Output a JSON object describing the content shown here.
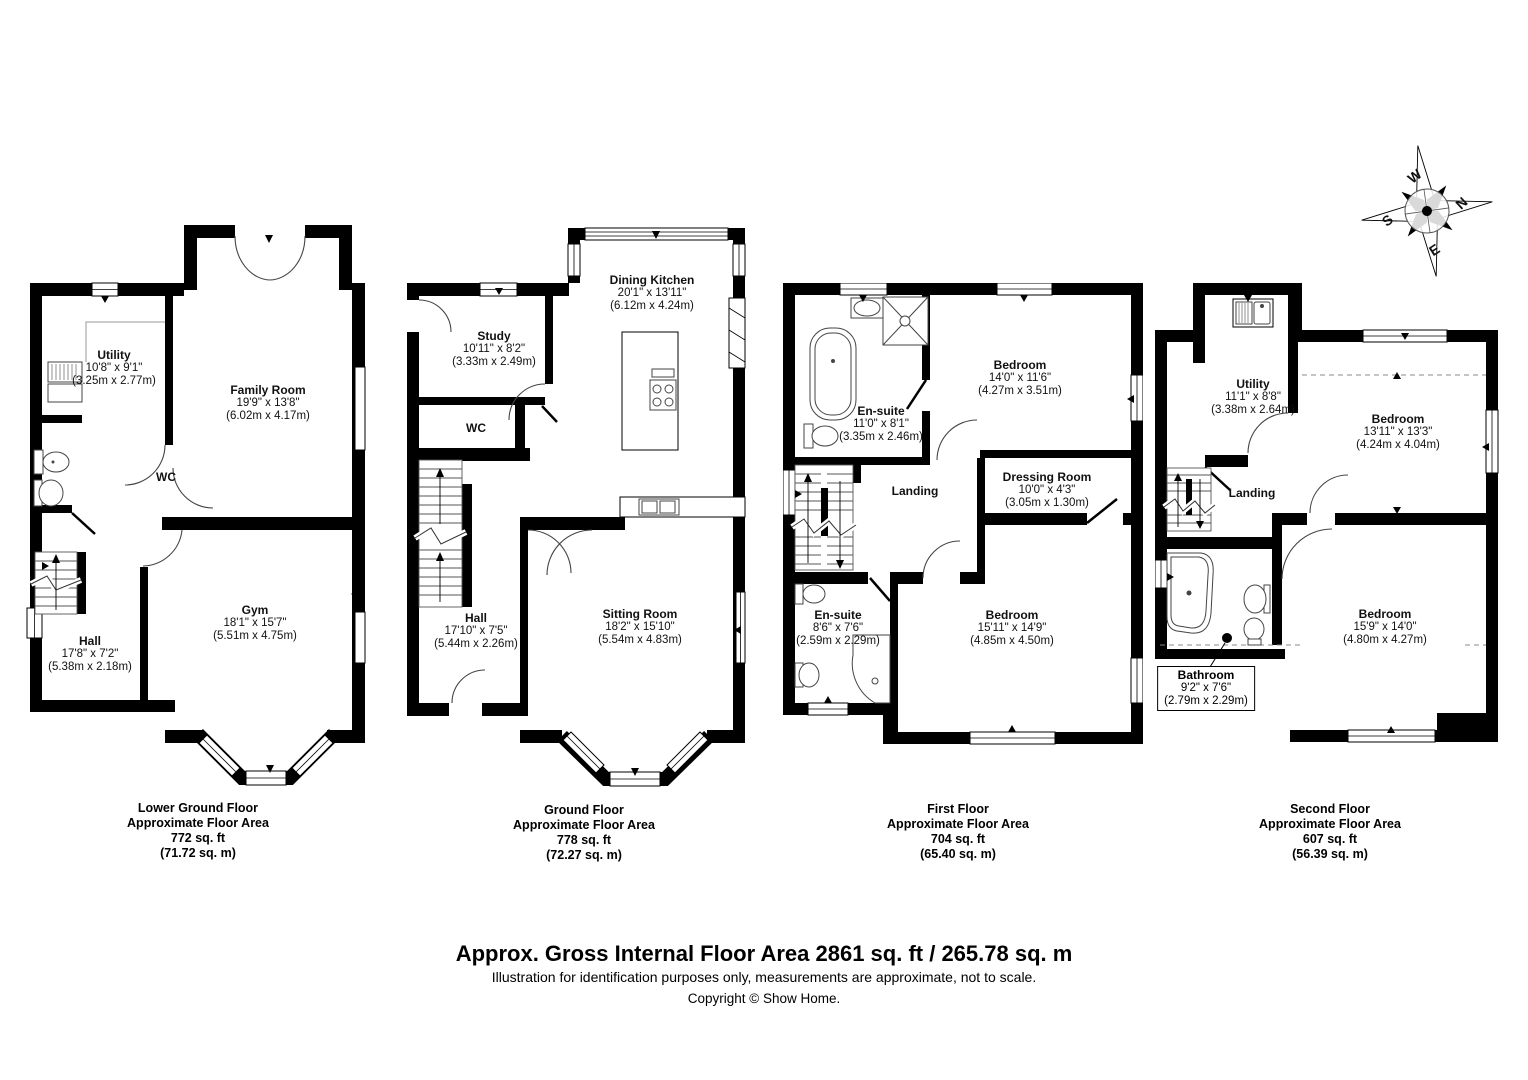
{
  "compass": {
    "n": "N",
    "e": "E",
    "s": "S",
    "w": "W"
  },
  "floors": [
    {
      "title": "Lower Ground Floor",
      "area_label": {
        "l1": "Lower Ground Floor",
        "l2": "Approximate Floor Area",
        "l3": "772 sq. ft",
        "l4": "(71.72 sq. m)"
      },
      "rooms": {
        "utility": {
          "name": "Utility",
          "imperial": "10'8\" x 9'1\"",
          "metric": "(3.25m x 2.77m)"
        },
        "family_room": {
          "name": "Family Room",
          "imperial": "19'9\" x 13'8\"",
          "metric": "(6.02m x 4.17m)"
        },
        "wc": {
          "name": "WC"
        },
        "hall": {
          "name": "Hall",
          "imperial": "17'8\" x 7'2\"",
          "metric": "(5.38m x 2.18m)"
        },
        "gym": {
          "name": "Gym",
          "imperial": "18'1\" x 15'7\"",
          "metric": "(5.51m x 4.75m)"
        }
      }
    },
    {
      "title": "Ground Floor",
      "area_label": {
        "l1": "Ground Floor",
        "l2": "Approximate Floor Area",
        "l3": "778 sq. ft",
        "l4": "(72.27 sq. m)"
      },
      "rooms": {
        "study": {
          "name": "Study",
          "imperial": "10'11\" x 8'2\"",
          "metric": "(3.33m x 2.49m)"
        },
        "dining_kitchen": {
          "name": "Dining Kitchen",
          "imperial": "20'1\" x 13'11\"",
          "metric": "(6.12m x 4.24m)"
        },
        "wc": {
          "name": "WC"
        },
        "hall": {
          "name": "Hall",
          "imperial": "17'10\" x 7'5\"",
          "metric": "(5.44m x 2.26m)"
        },
        "sitting_room": {
          "name": "Sitting Room",
          "imperial": "18'2\" x 15'10\"",
          "metric": "(5.54m x 4.83m)"
        }
      }
    },
    {
      "title": "First Floor",
      "area_label": {
        "l1": "First Floor",
        "l2": "Approximate Floor Area",
        "l3": "704 sq. ft",
        "l4": "(65.40 sq. m)"
      },
      "rooms": {
        "ensuite1": {
          "name": "En-suite",
          "imperial": "11'0\" x 8'1\"",
          "metric": "(3.35m x 2.46m)"
        },
        "bedroom1": {
          "name": "Bedroom",
          "imperial": "14'0\" x 11'6\"",
          "metric": "(4.27m x 3.51m)"
        },
        "landing": {
          "name": "Landing"
        },
        "dressing_room": {
          "name": "Dressing Room",
          "imperial": "10'0\" x 4'3\"",
          "metric": "(3.05m x 1.30m)"
        },
        "ensuite2": {
          "name": "En-suite",
          "imperial": "8'6\" x 7'6\"",
          "metric": "(2.59m x 2.29m)"
        },
        "bedroom2": {
          "name": "Bedroom",
          "imperial": "15'11\" x 14'9\"",
          "metric": "(4.85m x 4.50m)"
        }
      }
    },
    {
      "title": "Second Floor",
      "area_label": {
        "l1": "Second Floor",
        "l2": "Approximate Floor Area",
        "l3": "607 sq. ft",
        "l4": "(56.39 sq. m)"
      },
      "rooms": {
        "utility": {
          "name": "Utility",
          "imperial": "11'1\" x 8'8\"",
          "metric": "(3.38m x 2.64m)"
        },
        "bedroom3": {
          "name": "Bedroom",
          "imperial": "13'11\" x 13'3\"",
          "metric": "(4.24m x 4.04m)"
        },
        "landing": {
          "name": "Landing"
        },
        "bathroom": {
          "name": "Bathroom",
          "imperial": "9'2\" x 7'6\"",
          "metric": "(2.79m x 2.29m)"
        },
        "bedroom4": {
          "name": "Bedroom",
          "imperial": "15'9\" x 14'0\"",
          "metric": "(4.80m x 4.27m)"
        }
      }
    }
  ],
  "footer": {
    "line1": "Approx. Gross Internal Floor Area 2861 sq. ft / 265.78 sq. m",
    "line2": "Illustration for identification purposes only, measurements are approximate, not to scale.",
    "line3": "Copyright © Show Home."
  }
}
